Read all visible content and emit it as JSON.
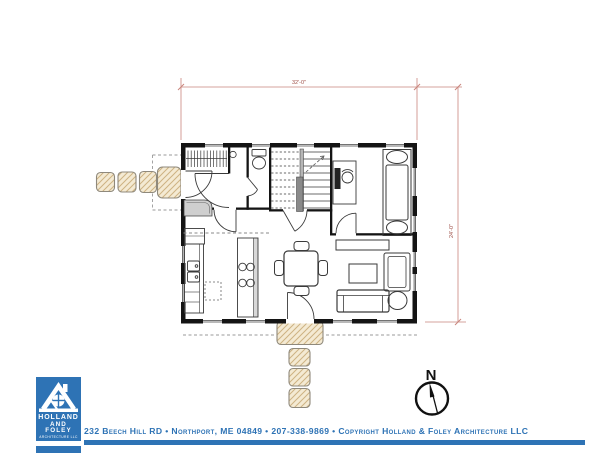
{
  "title": "Residential first floor plan drawing",
  "plan": {
    "dimensions": {
      "top": "32'-0\"",
      "right": "24'-0\""
    },
    "north_label": "N",
    "colors": {
      "dimension_line": "#c9857d",
      "dimension_text": "#9e4f47",
      "wall": "#141414",
      "hatch_fill": "#f4ead3",
      "hatch_line": "#cdb282",
      "accent_blue": "#2e73b5"
    },
    "icons": {
      "north_compass": "north-compass-icon",
      "logo_house": "house-with-round-window-icon"
    }
  },
  "logo": {
    "line1": "HOLLAND",
    "line2": "AND FOLEY",
    "line3": "ARCHITECTURE LLC"
  },
  "footer": {
    "text": "232 Beech Hill RD • Northport, ME 04849 • 207-338-9869 • Copyright Holland & Foley Architecture LLC"
  }
}
